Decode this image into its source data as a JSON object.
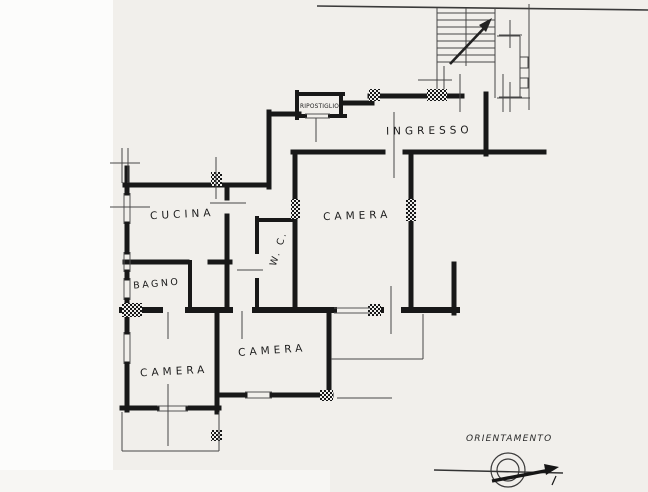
{
  "drawing": {
    "type": "apartment floor plan (scanned)",
    "rooms": {
      "ingresso": "INGRESSO",
      "ripostiglio": "RIPOSTIGLIO",
      "cucina": "CUCINA",
      "bagno": "BAGNO",
      "wc": "W. C.",
      "camera_top": "CAMERA",
      "camera_left": "CAMERA",
      "camera_middle": "CAMERA"
    },
    "compass": {
      "label": "ORIENTAMENTO"
    },
    "colors": {
      "paper": "#f1efeb",
      "paper_margin": "#fcfcfb",
      "ink": "#181818",
      "thin_line": "#474747"
    }
  }
}
